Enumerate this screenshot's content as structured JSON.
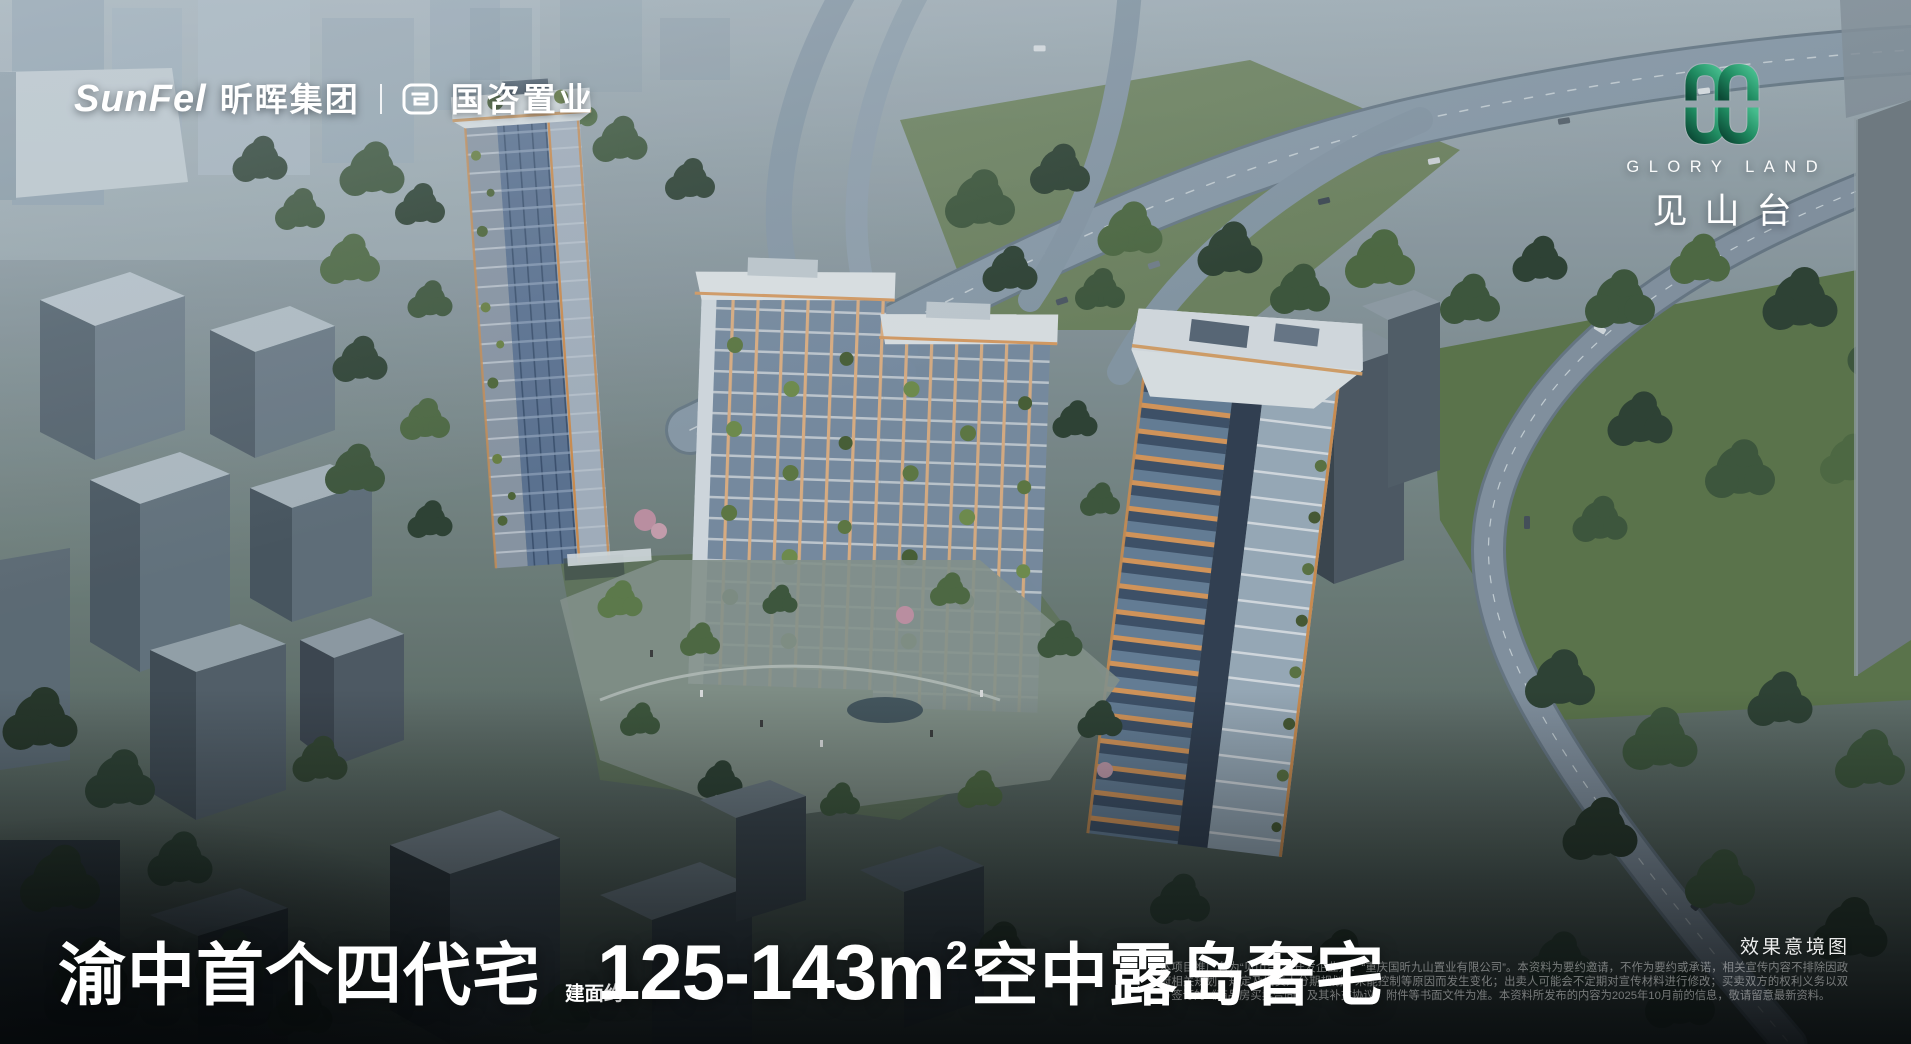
{
  "brand_bar": {
    "wordmark_latin": "SunFel",
    "wordmark_cn": "昕晖集团",
    "partner_cn": "国咨置业"
  },
  "project_badge": {
    "latin": "GLORY LAND",
    "cn": "见山台"
  },
  "headline": {
    "prefix": "渝中首个四代宅",
    "area_label": "建面约",
    "area_value": "125-143m",
    "area_sup": "2",
    "suffix": "空中露岛奢宅"
  },
  "caption": {
    "render_note": "效果意境图",
    "disclaimer": "本项目推广名为“见山台”；开发企业为：“重庆国昕九山置业有限公司”。本资料为要约邀请，不作为要约或承诺，相关宣传内容不排除因政府相关规划、规定及出卖人分期规划、未能控制等原因而发生变化；出卖人可能会不定期对宣传材料进行修改；买卖双方的权利义务以双方签订的《商品房买卖合同》及其补充协议、附件等书面文件为准。本资料所发布的内容为2025年10月前的信息，敬请留意最新资料。"
  },
  "colors": {
    "accent_orange": "#E09A58",
    "emblem_green": "#1F8A60",
    "glass_blue": "#6E85A8",
    "headline_white": "#FFFFFF"
  }
}
